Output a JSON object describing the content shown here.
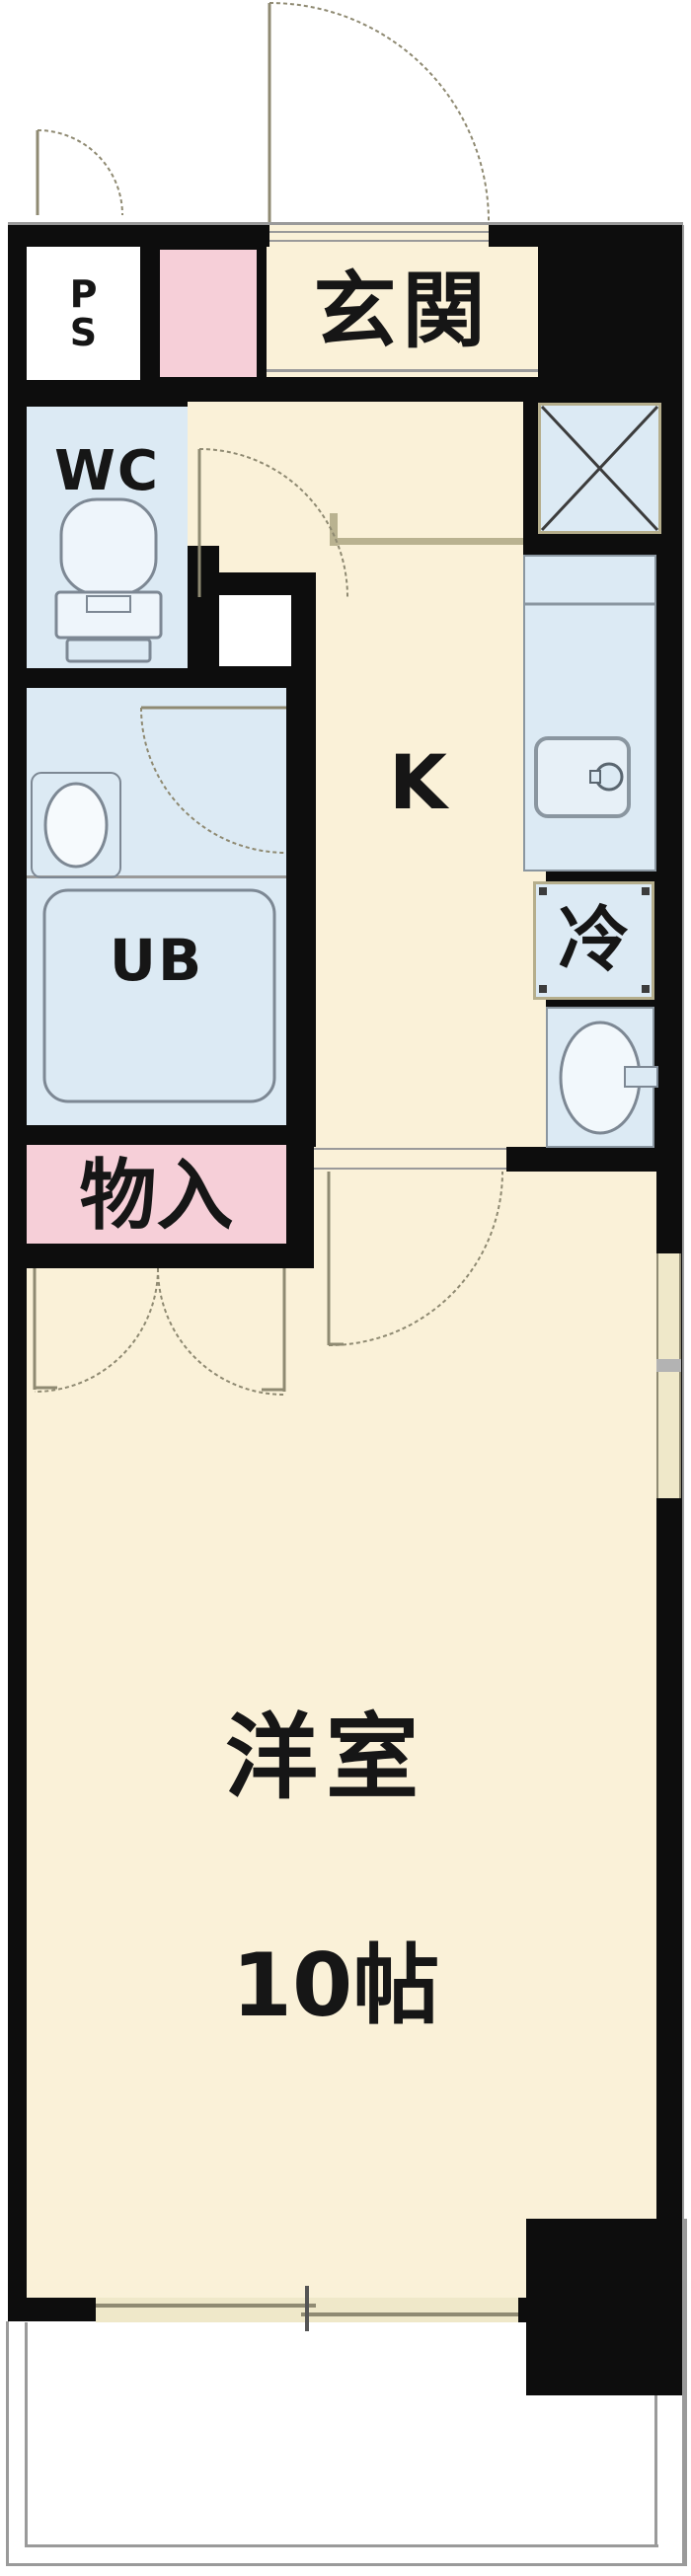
{
  "title": "apartment-floor-plan",
  "rooms": {
    "ps": {
      "label": "P\nS"
    },
    "genkan": {
      "label": "玄関"
    },
    "wc": {
      "label": "WC"
    },
    "kitchen": {
      "label": "K"
    },
    "fridge": {
      "label": "冷"
    },
    "unit_bath": {
      "label": "UB"
    },
    "storage": {
      "label": "物入"
    },
    "main_room": {
      "label": "洋室",
      "size": "10帖"
    }
  },
  "fixtures": [
    "entrance-door-arc",
    "ps-door-arc",
    "wc-door-arc",
    "washroom-door-arc",
    "kitchen-room-door-arc",
    "closet-double-door-arcs",
    "toilet",
    "wash-basin",
    "unit-bath-tub",
    "kitchen-sink",
    "duct-x-space",
    "laundry-pan",
    "balcony",
    "sliding-window-right-wall",
    "sliding-window-balcony"
  ],
  "colors": {
    "wall": "#0d0d0d",
    "floor_cream": "#faf1d8",
    "wet_area_blue": "#dceaf4",
    "storage_pink": "#f6cfd8",
    "window_tan": "#efe8c9",
    "line_olive": "#8f8a72",
    "outline_gray": "#9a9a9a"
  }
}
